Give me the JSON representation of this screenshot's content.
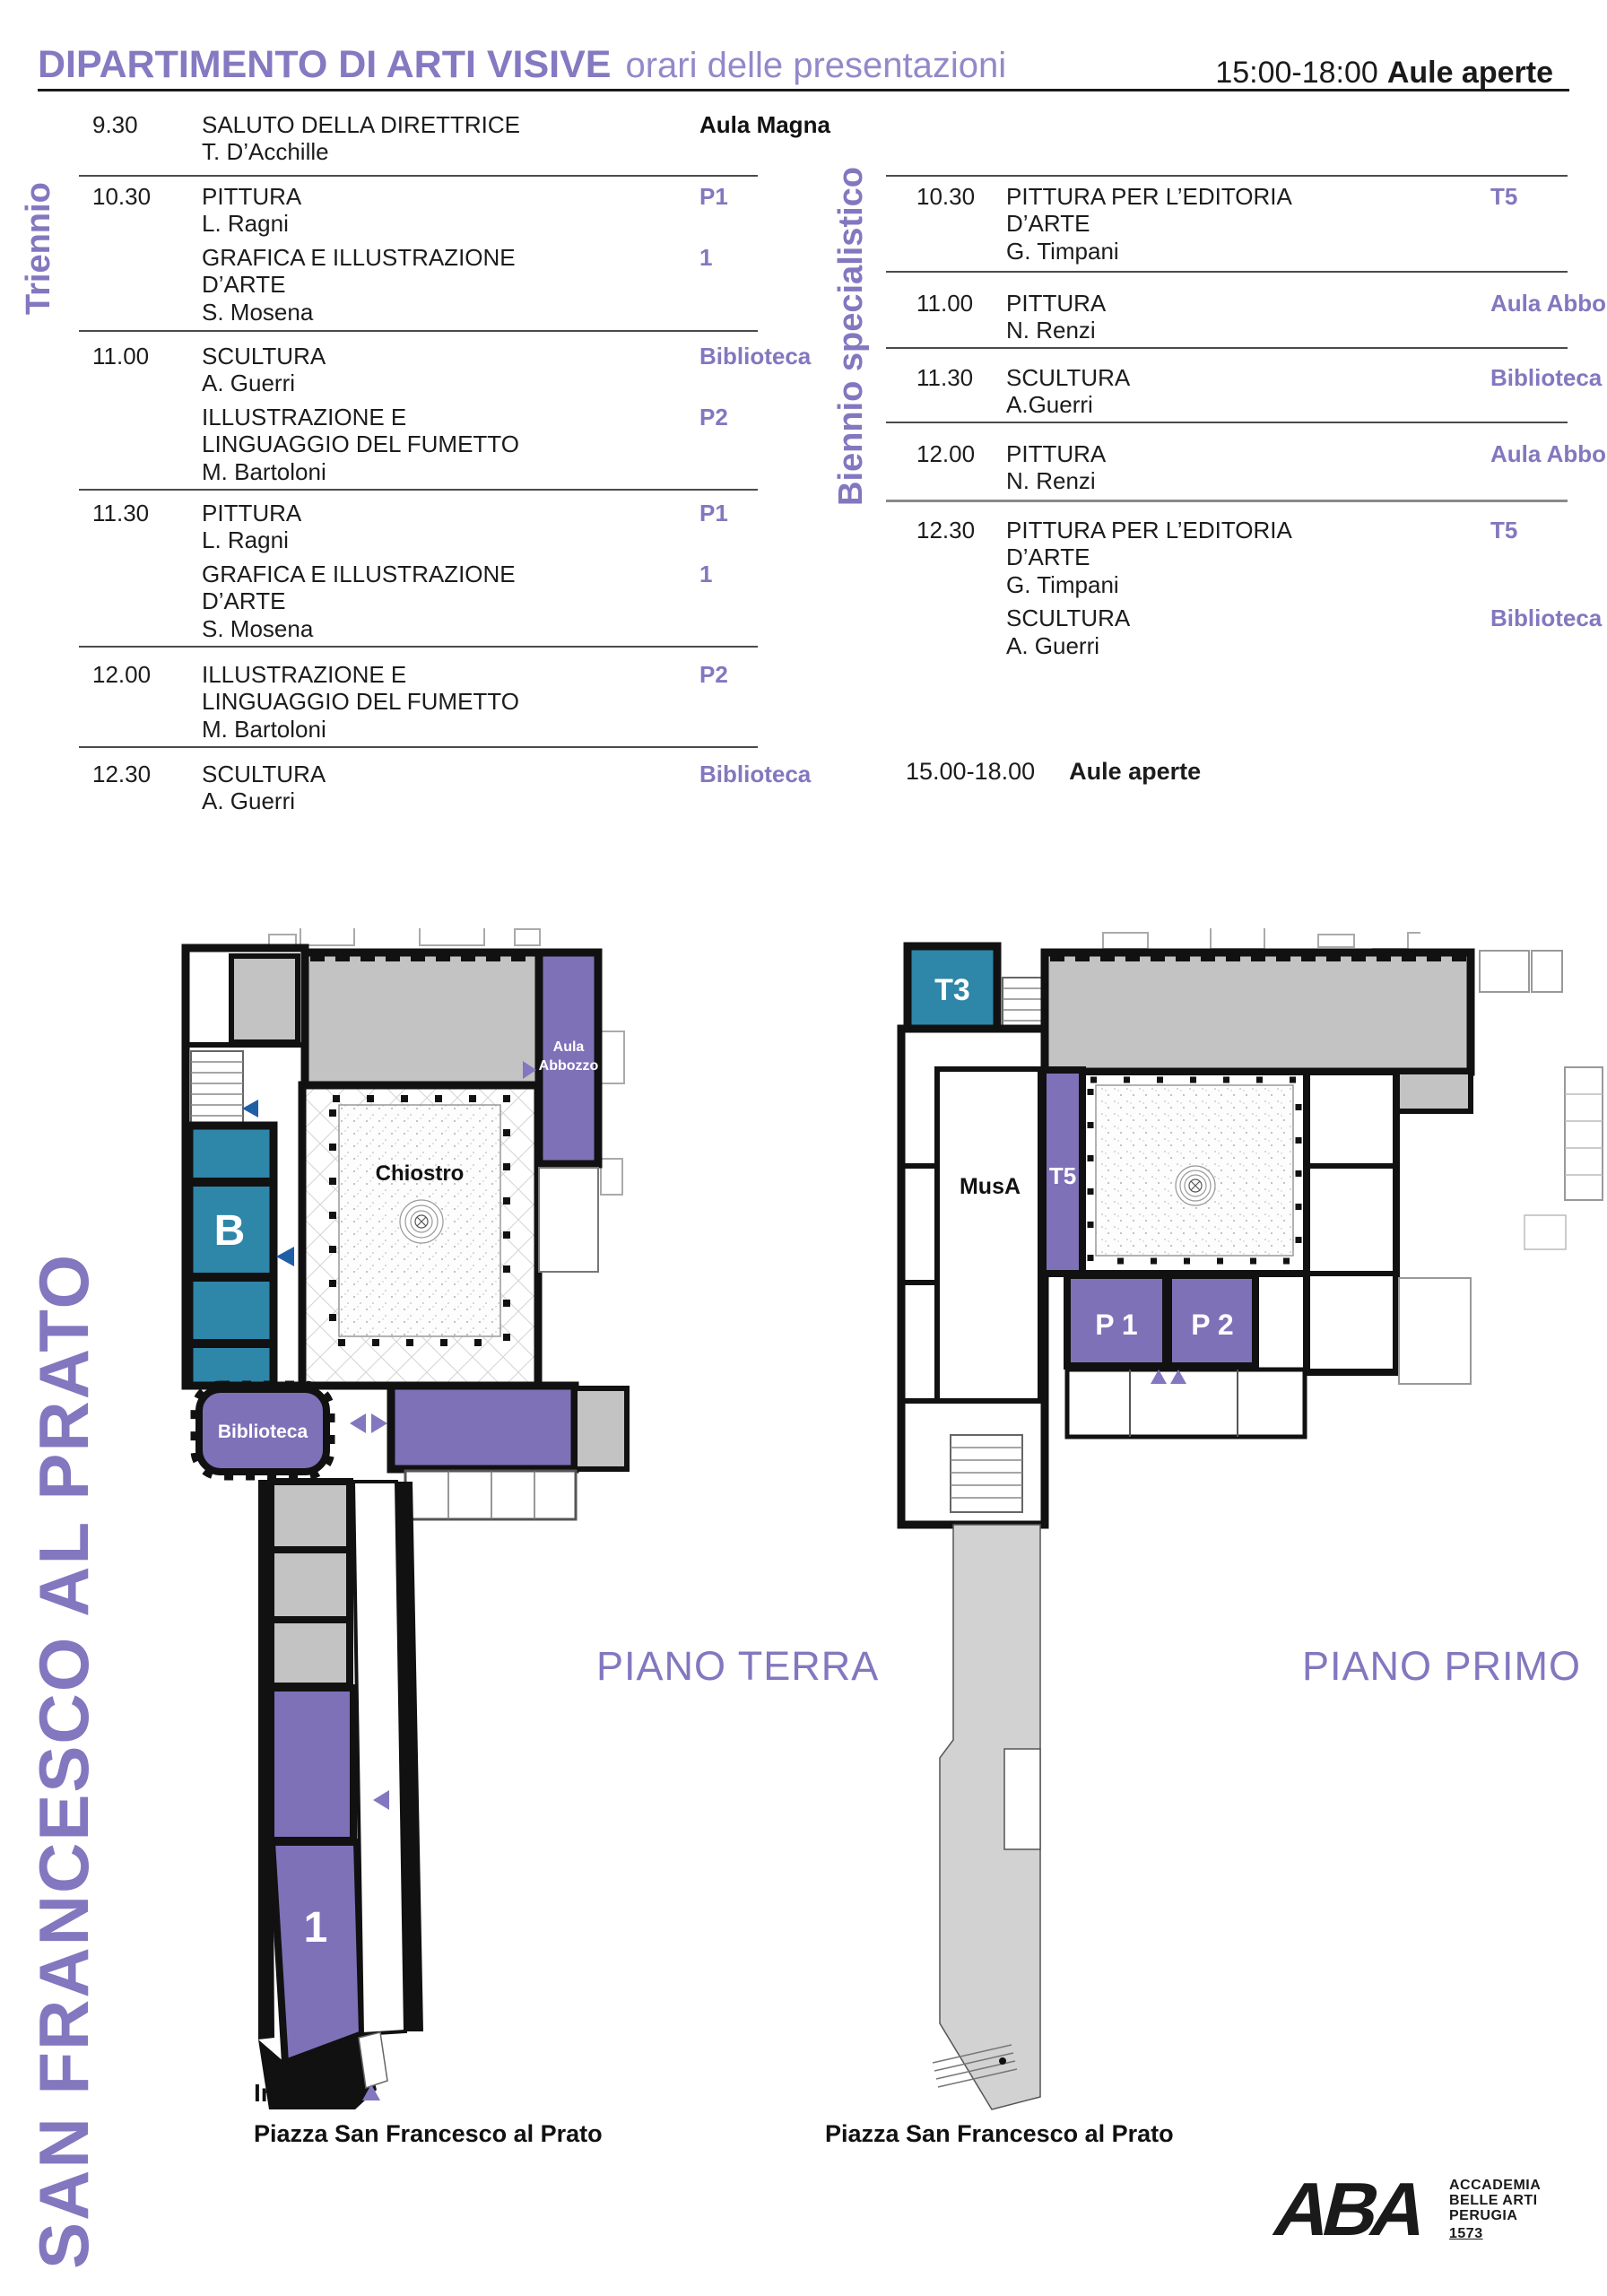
{
  "header": {
    "title": "DIPARTIMENTO DI ARTI VISIVE",
    "subtitle": "orari delle presentazioni",
    "hours": "15:00-18:00",
    "hours_label": "Aule aperte"
  },
  "schedule": {
    "triennio": {
      "label": "Triennio",
      "rows": [
        {
          "time": "9.30",
          "sessions": [
            {
              "title": "SALUTO DELLA DIRETTRICE",
              "speaker": "T. D’Acchille",
              "room": "Aula Magna"
            }
          ]
        },
        {
          "time": "10.30",
          "sessions": [
            {
              "title": "PITTURA",
              "speaker": "L. Ragni",
              "room": "P1"
            },
            {
              "title": "GRAFICA E ILLUSTRAZIONE D’ARTE",
              "speaker": "S. Mosena",
              "room": "1"
            }
          ]
        },
        {
          "time": "11.00",
          "sessions": [
            {
              "title": "SCULTURA",
              "speaker": "A. Guerri",
              "room": "Biblioteca"
            },
            {
              "title": "ILLUSTRAZIONE E LINGUAGGIO DEL FUMETTO",
              "speaker": "M. Bartoloni",
              "room": "P2"
            }
          ]
        },
        {
          "time": "11.30",
          "sessions": [
            {
              "title": "PITTURA",
              "speaker": "L. Ragni",
              "room": "P1"
            },
            {
              "title": "GRAFICA E ILLUSTRAZIONE D’ARTE",
              "speaker": "S. Mosena",
              "room": "1"
            }
          ]
        },
        {
          "time": "12.00",
          "sessions": [
            {
              "title": "ILLUSTRAZIONE E LINGUAGGIO DEL FUMETTO",
              "speaker": "M. Bartoloni",
              "room": "P2"
            }
          ]
        },
        {
          "time": "12.30",
          "sessions": [
            {
              "title": "SCULTURA",
              "speaker": "A. Guerri",
              "room": "Biblioteca"
            }
          ]
        }
      ]
    },
    "biennio": {
      "label": "Biennio specialistico",
      "rows": [
        {
          "time": "10.30",
          "sessions": [
            {
              "title": "PITTURA PER L’EDITORIA D’ARTE",
              "speaker": "G. Timpani",
              "room": "T5"
            }
          ]
        },
        {
          "time": "11.00",
          "sessions": [
            {
              "title": "PITTURA",
              "speaker": "N. Renzi",
              "room": "Aula Abbozzo"
            }
          ]
        },
        {
          "time": "11.30",
          "sessions": [
            {
              "title": "SCULTURA",
              "speaker": "A.Guerri",
              "room": "Biblioteca"
            }
          ]
        },
        {
          "time": "12.00",
          "sessions": [
            {
              "title": "PITTURA",
              "speaker": "N. Renzi",
              "room": "Aula Abbozzo"
            }
          ]
        },
        {
          "time": "12.30",
          "sessions": [
            {
              "title": "PITTURA PER L’EDITORIA D’ARTE",
              "speaker": "G. Timpani",
              "room": "T5"
            },
            {
              "title": "SCULTURA",
              "speaker": "A. Guerri",
              "room": "Biblioteca"
            }
          ]
        }
      ],
      "footer_time": "15.00-18.00",
      "footer_label": "Aule aperte"
    }
  },
  "building": {
    "name": "SAN FRANCESCO AL PRATO"
  },
  "plans": {
    "terra": {
      "title": "PIANO TERRA",
      "rooms": {
        "aula_abbozzo_1": "Aula",
        "aula_abbozzo_2": "Abbozzo",
        "chiostro": "Chiostro",
        "b": "B",
        "biblioteca": "Biblioteca",
        "one": "1"
      },
      "ingresso": "Ingresso",
      "piazza": "Piazza San Francesco al Prato"
    },
    "primo": {
      "title": "PIANO PRIMO",
      "rooms": {
        "t3": "T3",
        "musa": "MusA",
        "t5": "T5",
        "p1": "P 1",
        "p2": "P 2"
      },
      "piazza": "Piazza San Francesco al Prato"
    }
  },
  "logo": {
    "glyph": "ABA",
    "line1": "ACCADEMIA",
    "line2": "BELLE ARTI",
    "line3": "PERUGIA",
    "line4": "1573"
  },
  "colors": {
    "purple_text": "#8377BF",
    "purple_fill": "#7E71B8",
    "teal": "#2E86A8",
    "arrow_blue": "#1E5FA5",
    "gray": "#C3C3C3",
    "church_gray": "#D2D2D2"
  }
}
